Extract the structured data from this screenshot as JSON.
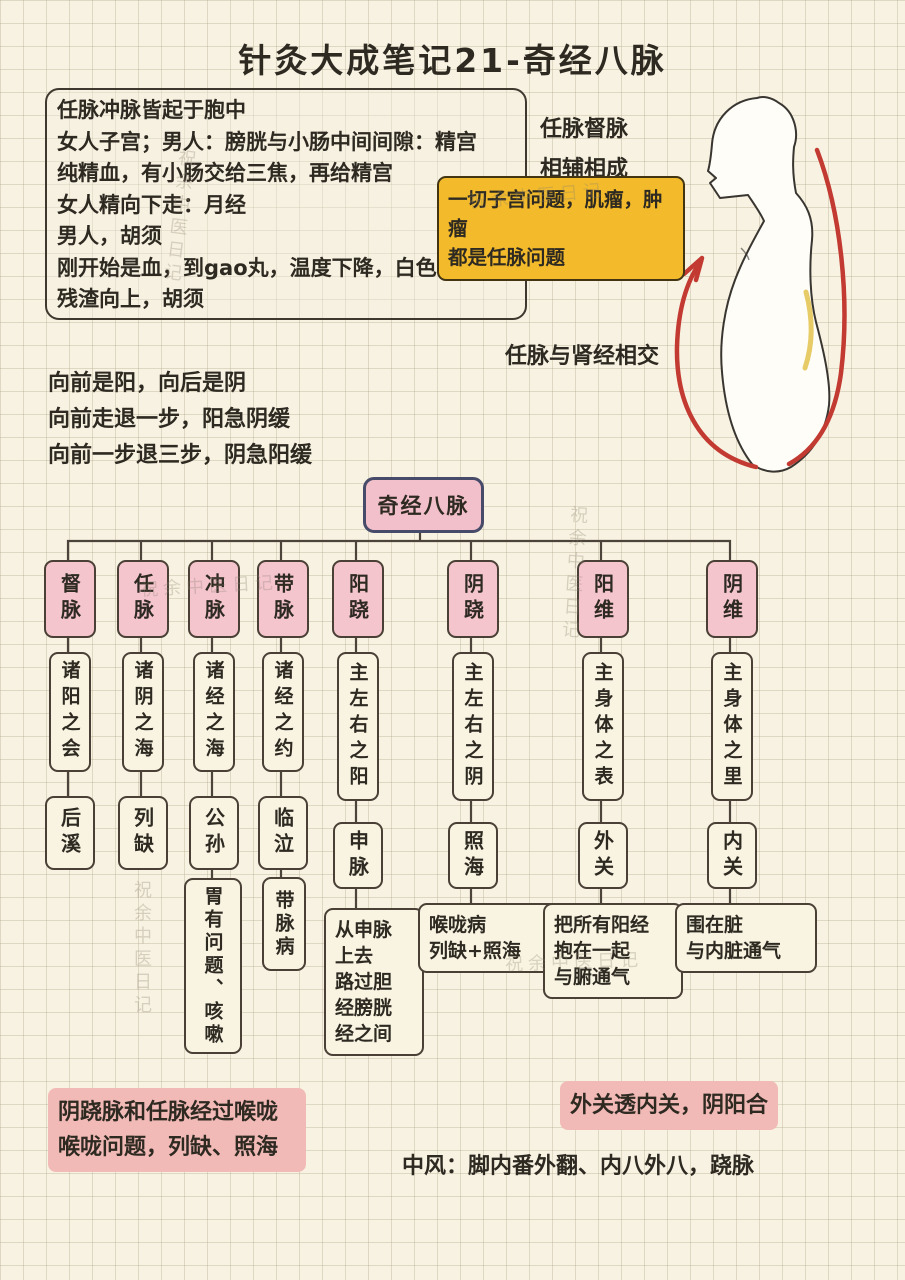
{
  "page": {
    "title": "针灸大成笔记21-奇经八脉",
    "watermark": "祝余中医日记"
  },
  "colors": {
    "paper": "#f7f2e1",
    "ink": "#2e2a22",
    "branch_pink": "#f5c5ce",
    "root_pink": "#f2c0ca",
    "yellow_note": "#f3bb2b",
    "highlight_pink": "#f2bab6",
    "arrow_red": "#c23a31"
  },
  "notes": {
    "main_box": {
      "lines": [
        "任脉冲脉皆起于胞中",
        "女人子宫；男人：膀胱与小肠中间间隙：精宫",
        "纯精血，有小肠交给三焦，再给精宫",
        "女人精向下走：月经",
        "男人，胡须",
        "刚开始是血，到gao丸，温度下降，白色",
        "残渣向上，胡须"
      ]
    },
    "side_note": "任脉督脉\n相辅相成",
    "yellow_note": "一切子宫问题，肌瘤，肿瘤\n都是任脉问题",
    "figure_caption": "任脉与肾经相交",
    "yinyang_lines": [
      "向前是阳，向后是阴",
      "向前走退一步，阳急阴缓",
      "向前一步退三步，阴急阳缓"
    ],
    "bottom_left": "阴跷脉和任脉经过喉咙\n喉咙问题，列缺、照海",
    "bottom_right": "外关透内关，阴阳合",
    "bottom_plain": "中风：脚内番外翻、内八外八，跷脉"
  },
  "tree": {
    "root": "奇经八脉",
    "columns": [
      {
        "branch": "督脉",
        "desc": "诸阳之会",
        "point": "后溪",
        "note": ""
      },
      {
        "branch": "任脉",
        "desc": "诸阴之海",
        "point": "列缺",
        "note": ""
      },
      {
        "branch": "冲脉",
        "desc": "诸经之海",
        "point": "公孙",
        "note": "胃有问题、咳嗽"
      },
      {
        "branch": "带脉",
        "desc": "诸经之约",
        "point": "临泣",
        "note": "带脉病"
      },
      {
        "branch": "阳跷",
        "desc": "主左右之阳",
        "point": "申脉",
        "note": "从申脉\n上去\n路过胆\n经膀胱\n经之间"
      },
      {
        "branch": "阴跷",
        "desc": "主左右之阴",
        "point": "照海",
        "note": "喉咙病\n列缺+照海"
      },
      {
        "branch": "阳维",
        "desc": "主身体之表",
        "point": "外关",
        "note": "把所有阳经\n抱在一起\n与腑通气"
      },
      {
        "branch": "阴维",
        "desc": "主身体之里",
        "point": "内关",
        "note": "围在脏\n与内脏通气"
      }
    ]
  }
}
